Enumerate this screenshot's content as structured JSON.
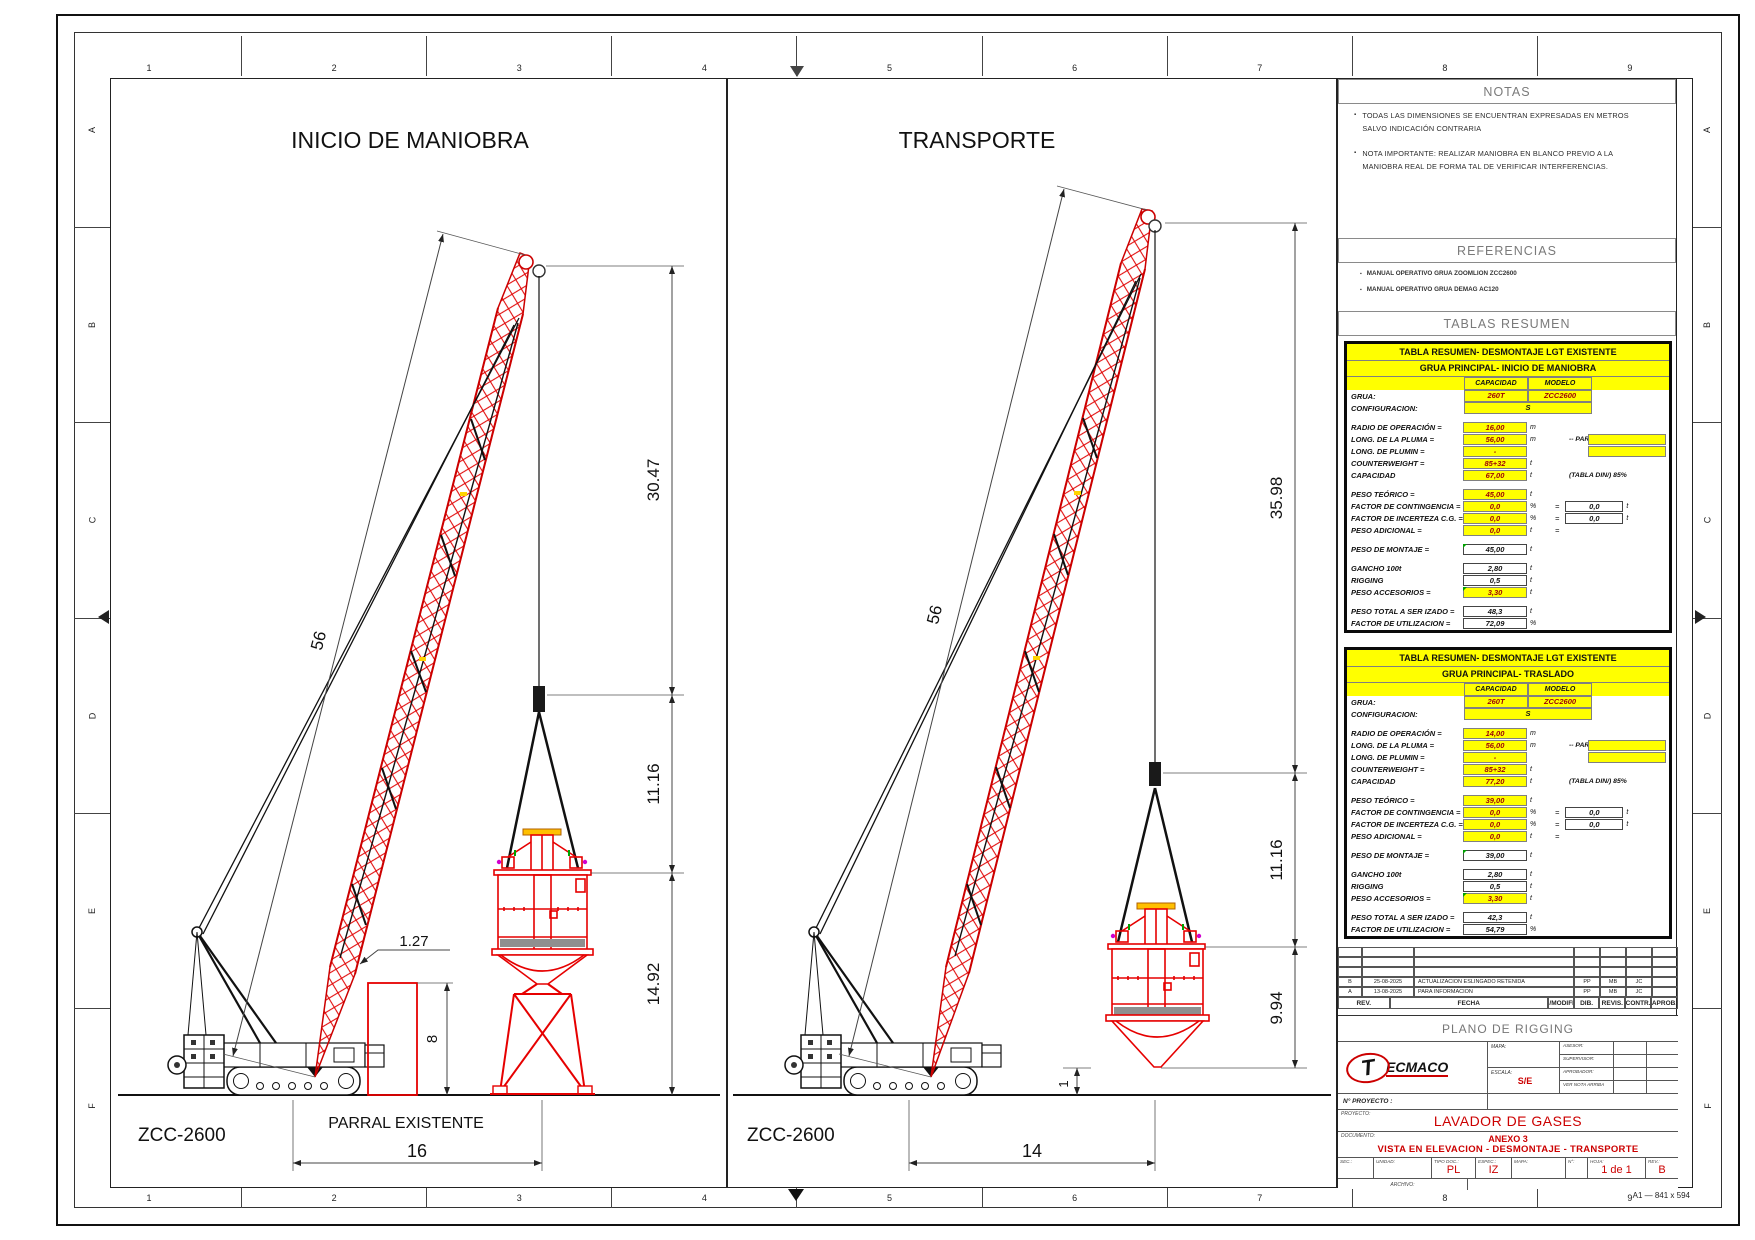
{
  "sheet": {
    "columns": [
      "1",
      "2",
      "3",
      "4",
      "5",
      "6",
      "7",
      "8",
      "9"
    ],
    "rows": [
      "A",
      "B",
      "C",
      "D",
      "E",
      "F"
    ],
    "format": "A1 — 841 x 594"
  },
  "panels": {
    "inicio": {
      "title": "INICIO DE MANIOBRA",
      "crane": "ZCC-2600",
      "ground": "PARRAL EXISTENTE",
      "dim_boom": "56",
      "dim_tip": "30.47",
      "dim_sling": "11.16",
      "dim_lower": "14.92",
      "dim_parral": "8",
      "dim_clear": "1.27",
      "dim_radius": "16"
    },
    "transporte": {
      "title": "TRANSPORTE",
      "crane": "ZCC-2600",
      "dim_boom": "56",
      "dim_tip": "35.98",
      "dim_sling": "11.16",
      "dim_load": "9.94",
      "dim_ground": "1",
      "dim_radius": "14"
    }
  },
  "notas": {
    "title": "NOTAS",
    "items": [
      [
        "TODAS LAS DIMENSIONES SE ENCUENTRAN EXPRESADAS EN METROS",
        "SALVO INDICACIÓN CONTRARIA"
      ],
      [
        "NOTA IMPORTANTE: REALIZAR MANIOBRA EN BLANCO PREVIO A LA",
        "MANIOBRA REAL DE FORMA TAL DE VERIFICAR INTERFERENCIAS."
      ]
    ]
  },
  "referencias": {
    "title": "REFERENCIAS",
    "items": [
      "MANUAL OPERATIVO GRUA ZOOMLION ZCC2600",
      "MANUAL OPERATIVO GRUA DEMAG AC120"
    ]
  },
  "tablas": {
    "title": "TABLAS RESUMEN",
    "tables": [
      {
        "header1": "TABLA RESUMEN- DESMONTAJE LGT EXISTENTE",
        "header2": "GRUA PRINCIPAL- INICIO DE MANIOBRA",
        "col1": "CAPACIDAD",
        "col2": "MODELO",
        "grua_label": "GRUA:",
        "grua_cap": "260T",
        "grua_mod": "ZCC2600",
        "config_label": "CONFIGURACION:",
        "config": "S",
        "rows": [
          {
            "label": "RADIO DE OPERACIÓN =",
            "value": "16,00",
            "bg": "y",
            "unit": "m",
            "gap": "1"
          },
          {
            "label": "LONG. DE LA PLUMA =",
            "value": "56,00",
            "bg": "y",
            "unit": "m",
            "note": "-- PARTES:",
            "pbox": "1"
          },
          {
            "label": "LONG. DE PLUMIN =",
            "value": "-",
            "bg": "y",
            "pbox": "1"
          },
          {
            "label": "COUNTERWEIGHT =",
            "value": "85+32",
            "bg": "y",
            "unit": "t"
          },
          {
            "label": "CAPACIDAD",
            "value": "67,00",
            "bg": "y",
            "unit": "t",
            "note": "(TABLA DIN/) 85%"
          },
          {
            "label": "PESO TEÓRICO =",
            "value": "45,00",
            "bg": "y",
            "unit": "t",
            "gap": "1"
          },
          {
            "label": "FACTOR DE CONTINGENCIA =",
            "value": "0,0",
            "bg": "y",
            "unit": "%",
            "eq": "=",
            "xval": "0,0",
            "xunit": "t"
          },
          {
            "label": "FACTOR DE INCERTEZA C.G. =",
            "value": "0,0",
            "bg": "y",
            "unit": "%",
            "eq": "=",
            "xval": "0,0",
            "xunit": "t"
          },
          {
            "label": "PESO ADICIONAL =",
            "value": "0,0",
            "bg": "y",
            "unit": "t",
            "eq": "="
          },
          {
            "label": "PESO DE MONTAJE =",
            "value": "45,00",
            "bg": "w",
            "unit": "t",
            "gc": "1",
            "gap": "1"
          },
          {
            "label": "GANCHO 100t",
            "value": "2,80",
            "bg": "w",
            "unit": "t",
            "gap": "1"
          },
          {
            "label": "RIGGING",
            "value": "0,5",
            "bg": "w",
            "unit": "t"
          },
          {
            "label": "PESO ACCESORIOS =",
            "value": "3,30",
            "bg": "y",
            "unit": "t",
            "gc": "1"
          },
          {
            "label": "PESO TOTAL A SER IZADO =",
            "value": "48,3",
            "bg": "w",
            "unit": "t",
            "gap": "1"
          },
          {
            "label": "FACTOR DE UTILIZACION =",
            "value": "72,09",
            "bg": "w",
            "unit": "%"
          }
        ]
      },
      {
        "header1": "TABLA RESUMEN- DESMONTAJE LGT EXISTENTE",
        "header2": "GRUA PRINCIPAL- TRASLADO",
        "col1": "CAPACIDAD",
        "col2": "MODELO",
        "grua_label": "GRUA:",
        "grua_cap": "260T",
        "grua_mod": "ZCC2600",
        "config_label": "CONFIGURACION:",
        "config": "S",
        "rows": [
          {
            "label": "RADIO DE OPERACIÓN =",
            "value": "14,00",
            "bg": "y",
            "unit": "m",
            "gap": "1"
          },
          {
            "label": "LONG. DE LA PLUMA =",
            "value": "56,00",
            "bg": "y",
            "unit": "m",
            "note": "-- PARTES:",
            "pbox": "1"
          },
          {
            "label": "LONG. DE PLUMIN =",
            "value": "-",
            "bg": "y",
            "pbox": "1"
          },
          {
            "label": "COUNTERWEIGHT =",
            "value": "85+32",
            "bg": "y",
            "unit": "t"
          },
          {
            "label": "CAPACIDAD",
            "value": "77,20",
            "bg": "y",
            "unit": "t",
            "note": "(TABLA DIN/) 85%"
          },
          {
            "label": "PESO TEÓRICO =",
            "value": "39,00",
            "bg": "y",
            "unit": "t",
            "gap": "1"
          },
          {
            "label": "FACTOR DE CONTINGENCIA =",
            "value": "0,0",
            "bg": "y",
            "unit": "%",
            "eq": "=",
            "xval": "0,0",
            "xunit": "t"
          },
          {
            "label": "FACTOR DE INCERTEZA C.G. =",
            "value": "0,0",
            "bg": "y",
            "unit": "%",
            "eq": "=",
            "xval": "0,0",
            "xunit": "t"
          },
          {
            "label": "PESO ADICIONAL =",
            "value": "0,0",
            "bg": "y",
            "unit": "t",
            "eq": "="
          },
          {
            "label": "PESO DE MONTAJE =",
            "value": "39,00",
            "bg": "w",
            "unit": "t",
            "gc": "1",
            "gap": "1"
          },
          {
            "label": "GANCHO 100t",
            "value": "2,80",
            "bg": "w",
            "unit": "t",
            "gap": "1"
          },
          {
            "label": "RIGGING",
            "value": "0,5",
            "bg": "w",
            "unit": "t"
          },
          {
            "label": "PESO ACCESORIOS =",
            "value": "3,30",
            "bg": "y",
            "unit": "t",
            "gc": "1"
          },
          {
            "label": "PESO TOTAL A SER IZADO =",
            "value": "42,3",
            "bg": "w",
            "unit": "t",
            "gap": "1"
          },
          {
            "label": "FACTOR DE UTILIZACION =",
            "value": "54,79",
            "bg": "w",
            "unit": "%"
          }
        ]
      }
    ]
  },
  "revisiones": {
    "headers": [
      "REV.",
      "FECHA",
      "EMISIÓN/MODIFICACIÓN",
      "DIB.",
      "REVIS.",
      "CONTR.",
      "APROB."
    ],
    "rows": [
      {
        "rev": "B",
        "fecha": "25-08-2025",
        "desc": "ACTUALIZACION ESLINGADO RETENIDA",
        "dib": "PP",
        "revs": "MB",
        "contr": "JC",
        "aprob": ""
      },
      {
        "rev": "A",
        "fecha": "13-08-2025",
        "desc": "PARA INFORMACION",
        "dib": "PP",
        "revs": "MB",
        "contr": "JC",
        "aprob": ""
      }
    ]
  },
  "titulo": {
    "plano": "PLANO DE RIGGING",
    "logo_t": "T",
    "logo_rest": "ECMACO",
    "campos": {
      "mapa": "MAPA:",
      "escala": "ESCALA:",
      "escala_valor": "S/E",
      "asesor": "ASESOR:",
      "supervisor": "SUPERVISOR:",
      "aprobador": "APROBADOR:",
      "nota": "VER NOTA ARRIBA"
    },
    "nproyecto_label": "N° PROYECTO :",
    "proyecto_label": "PROYECTO:",
    "proyecto": "LAVADOR DE GASES",
    "documento_label": "DOCUMENTO:",
    "documento1": "ANEXO 3",
    "documento2": "VISTA EN ELEVACION - DESMONTAJE - TRANSPORTE",
    "pie": {
      "sec": "SEC.:",
      "unidad": "UNIDAD:",
      "tipodoc": "TIPO DOC.:",
      "tipodoc_v": "PL",
      "espec": "ESPEC.:",
      "espec_v": "IZ",
      "mapa": "MAPA:",
      "num": "N°:",
      "hoja": "HOJA:",
      "hoja_v": "1 de 1",
      "rev": "REV.:",
      "rev_v": "B"
    },
    "archivo": "ARCHIVO:"
  }
}
